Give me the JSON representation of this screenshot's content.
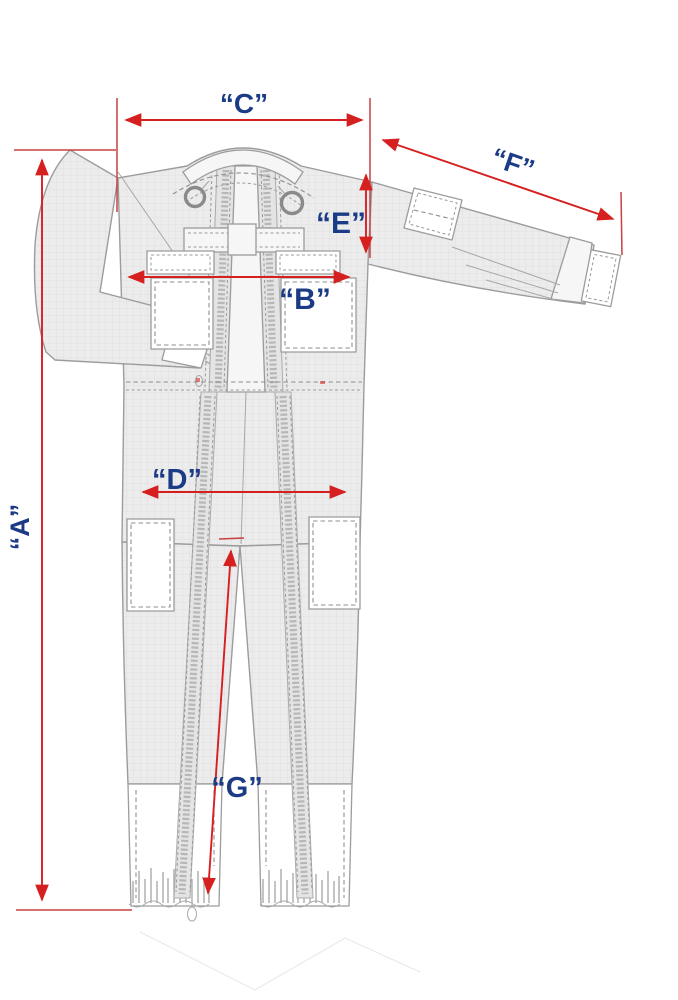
{
  "canvas": {
    "width": 678,
    "height": 1000,
    "background": "#ffffff"
  },
  "diagram": {
    "subject": "coverall-measurement-diagram",
    "arrow_color": "#d62020",
    "label_color": "#1c3b86",
    "labels": {
      "a": "“A”",
      "b": "“B”",
      "c": "“C”",
      "d": "“D”",
      "e": "“E”",
      "f": "“F”",
      "g": "“G”"
    },
    "dimensions": [
      {
        "id": "A",
        "label": "“A”",
        "orientation": "vertical-left-full-height"
      },
      {
        "id": "B",
        "label": "“B”",
        "orientation": "horizontal-chest"
      },
      {
        "id": "C",
        "label": "“C”",
        "orientation": "horizontal-top-shoulders"
      },
      {
        "id": "D",
        "label": "“D”",
        "orientation": "horizontal-hips"
      },
      {
        "id": "E",
        "label": "“E”",
        "orientation": "vertical-armhole"
      },
      {
        "id": "F",
        "label": "“F”",
        "orientation": "diagonal-sleeve"
      },
      {
        "id": "G",
        "label": "“G”",
        "orientation": "diagonal-inseam"
      }
    ]
  }
}
